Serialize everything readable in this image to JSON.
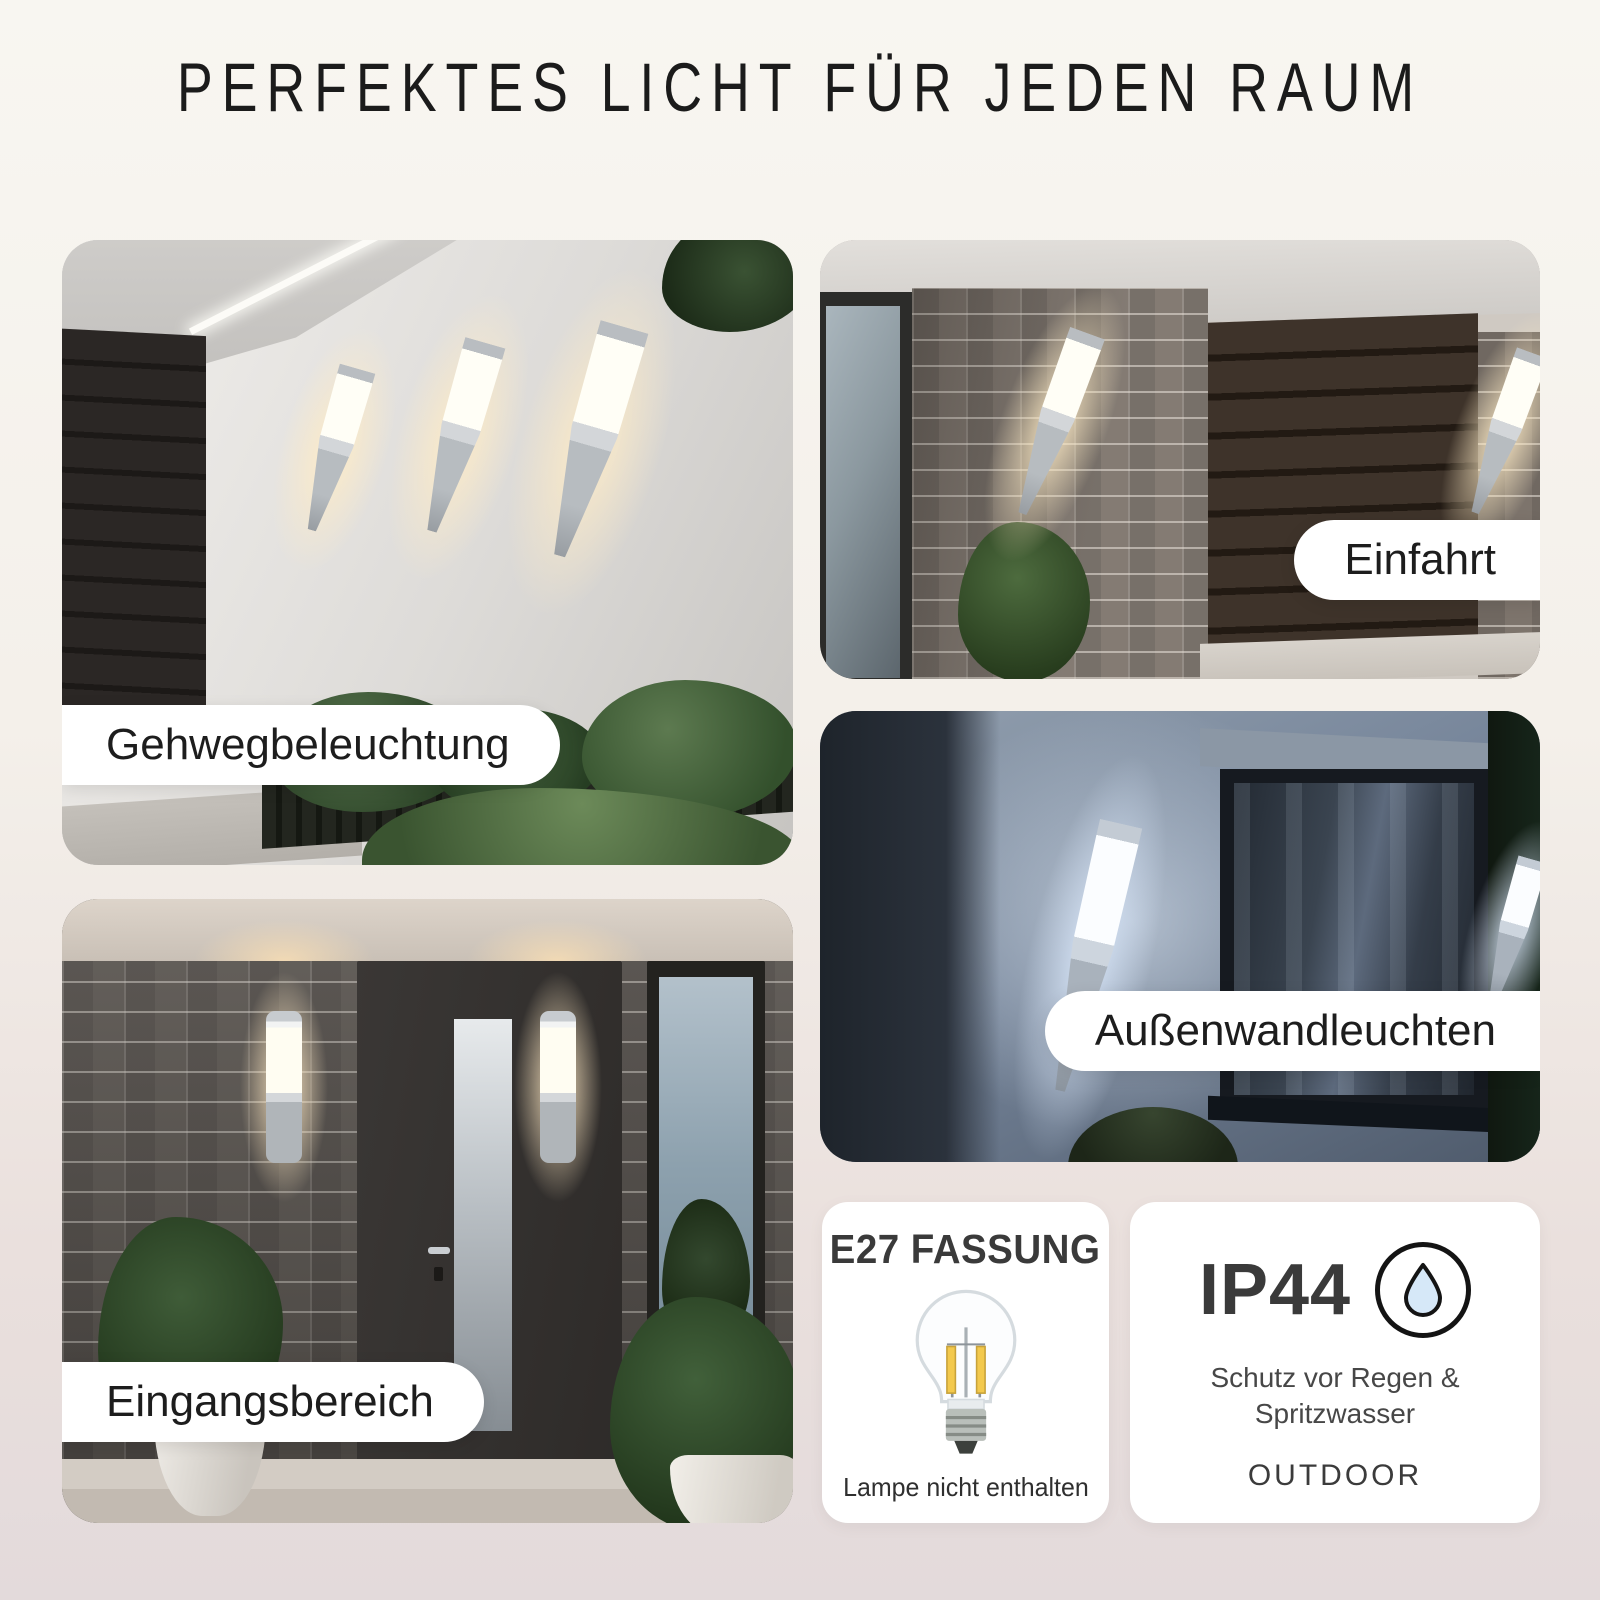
{
  "title": "PERFEKTES LICHT FÜR JEDEN RAUM",
  "panels": {
    "gehweg": {
      "label": "Gehwegbeleuchtung"
    },
    "einfahrt": {
      "label": "Einfahrt"
    },
    "aussenwand": {
      "label": "Außenwandleuchten"
    },
    "eingang": {
      "label": "Eingangsbereich"
    }
  },
  "cards": {
    "e27": {
      "title": "E27 FASSUNG",
      "icon": "filament-bulb-icon",
      "note": "Lampe nicht enthalten"
    },
    "ip44": {
      "title": "IP44",
      "icon": "water-droplet-icon",
      "protection_line1": "Schutz vor Regen &",
      "protection_line2": "Spritzwasser",
      "usage": "OUTDOOR"
    }
  },
  "colors": {
    "background_top": "#f8f6f1",
    "background_bottom": "#e3dadb",
    "card_background": "#ffffff",
    "text_dark": "#1d1d1d",
    "droplet_blue": "#d6e8f8",
    "warm_light": "#ffecc6",
    "cool_light": "#dbe9fc"
  }
}
